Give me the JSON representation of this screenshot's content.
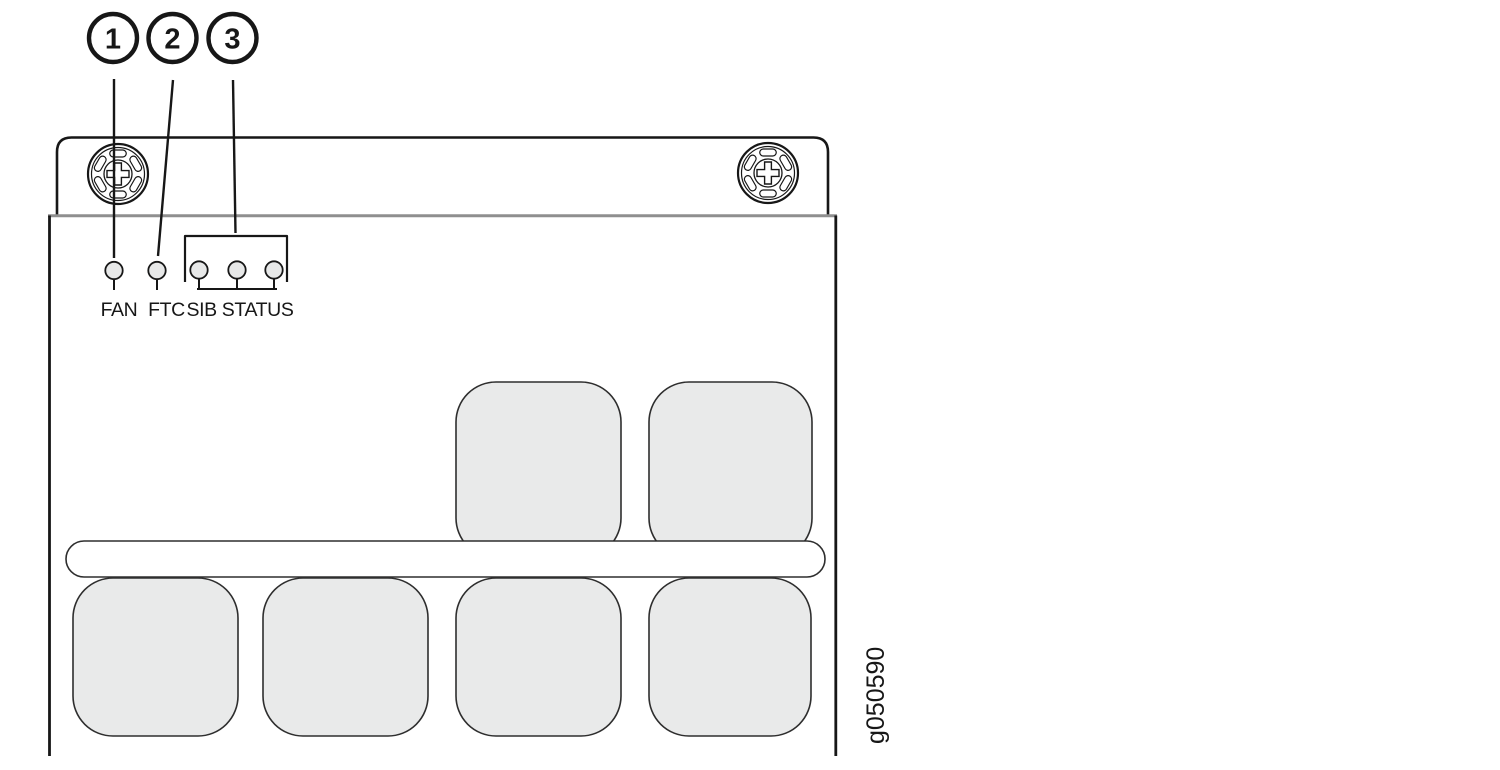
{
  "figure": {
    "figure_id": "g050590",
    "callouts": [
      {
        "number": "1",
        "points_to": "FAN LED"
      },
      {
        "number": "2",
        "points_to": "FTC LED"
      },
      {
        "number": "3",
        "points_to": "SIB STATUS LED group"
      }
    ],
    "leds": {
      "fan_label": "FAN",
      "ftc_label": "FTC",
      "sib_status_label": "SIB STATUS"
    },
    "icons": {
      "thumbscrew": "phillips-thumbscrew-icon",
      "led": "led-indicator-circle"
    },
    "colors": {
      "line": "#171717",
      "thin_line": "#2e2e2e",
      "divider_gray": "#8f8f8f",
      "block_fill": "#e9eaea",
      "led_fill": "#e7e8e8",
      "background": "#ffffff"
    }
  }
}
